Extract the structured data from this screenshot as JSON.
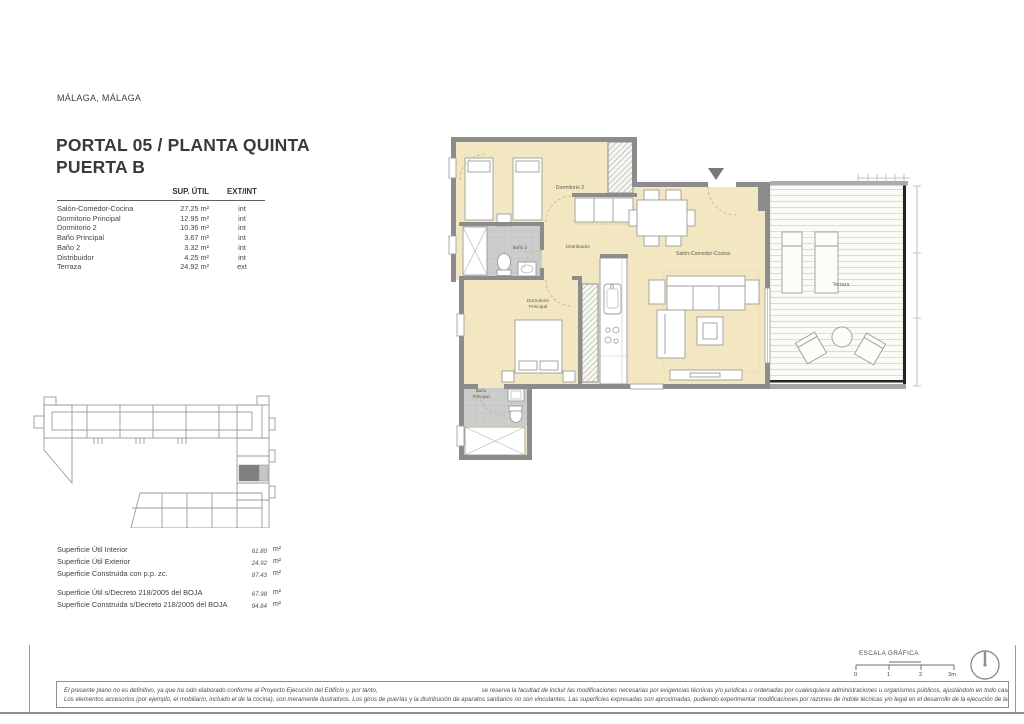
{
  "page": {
    "location": "MÁLAGA, MÁLAGA",
    "title_line1": "PORTAL 05 / PLANTA QUINTA",
    "title_line2": "PUERTA B"
  },
  "areas_table": {
    "headers": {
      "sup": "SUP. ÚTIL",
      "ext": "EXT/INT"
    },
    "rows": [
      {
        "name": "Salón-Comedor-Cocina",
        "area": "27.25 m²",
        "type": "int"
      },
      {
        "name": "Dormitorio Principal",
        "area": "12.95 m²",
        "type": "int"
      },
      {
        "name": "Dormitorio 2",
        "area": "10.36 m²",
        "type": "int"
      },
      {
        "name": "Baño Principal",
        "area": "3.67 m²",
        "type": "int"
      },
      {
        "name": "Baño 2",
        "area": "3.32 m²",
        "type": "int"
      },
      {
        "name": "Distribuidor",
        "area": "4.25 m²",
        "type": "int"
      },
      {
        "name": "Terraza",
        "area": "24.92 m²",
        "type": "ext"
      }
    ]
  },
  "totals": {
    "unit": "m²",
    "group1": [
      {
        "label": "Superficie Útil Interior",
        "value": "61.80"
      },
      {
        "label": "Superficie Útil Exterior",
        "value": "24.92"
      },
      {
        "label": "Superficie Construida con p.p. zc.",
        "value": "87.43"
      }
    ],
    "group2": [
      {
        "label": "Superficie Útil s/Decreto 218/2005 del BOJA",
        "value": "67.98"
      },
      {
        "label": "Superficie Construida s/Decreto 218/2005 del BOJA",
        "value": "94.64"
      }
    ]
  },
  "plan": {
    "labels": {
      "dormitorio2": "Dormitorio 2",
      "bano2": "Baño 2",
      "distribuidor": "Distribuidor",
      "dormitorio_principal_l1": "Dormitorio",
      "dormitorio_principal_l2": "Principal",
      "bano_principal_l1": "Baño",
      "bano_principal_l2": "Principal",
      "salon": "Salón-Comedor-Cocina",
      "terraza": "Terraza"
    },
    "colors": {
      "room_fill": "#f3e7c2",
      "wall": "#8c8c8c",
      "bath_tile": "#cdcdcd",
      "terrace_edge": "#242424",
      "keyplan_highlight": "#7f7f7f"
    }
  },
  "scale": {
    "label": "ESCALA GRÁFICA",
    "ticks": [
      "0",
      "1",
      "2",
      "3m"
    ]
  },
  "footer": {
    "line1a": "El presente plano no es definitivo, ya que ha sido elaborado conforme al Proyecto Ejecución del Edificio y, por tanto,",
    "line1b": "se reserva la facultad de incluir las modificaciones necesarias por exigencias técnicas y/o jurídicas u ordenadas por cualesquiera administraciones u organismos públicos, ajustándolo en todo caso a la Documentación Final de Obra.",
    "line2": "Los elementos accesorios (por ejemplo, el mobiliario, incluido el de la cocina), son meramente ilustrativos. Los giros de puertas y la distribución de aparatos sanitarios no son vinculantes. Las superficies expresadas son aproximadas, pudiendo experimentar modificaciones por razones de índole técnicas y/o legal en el desarrollo de la ejecución de las obras."
  }
}
